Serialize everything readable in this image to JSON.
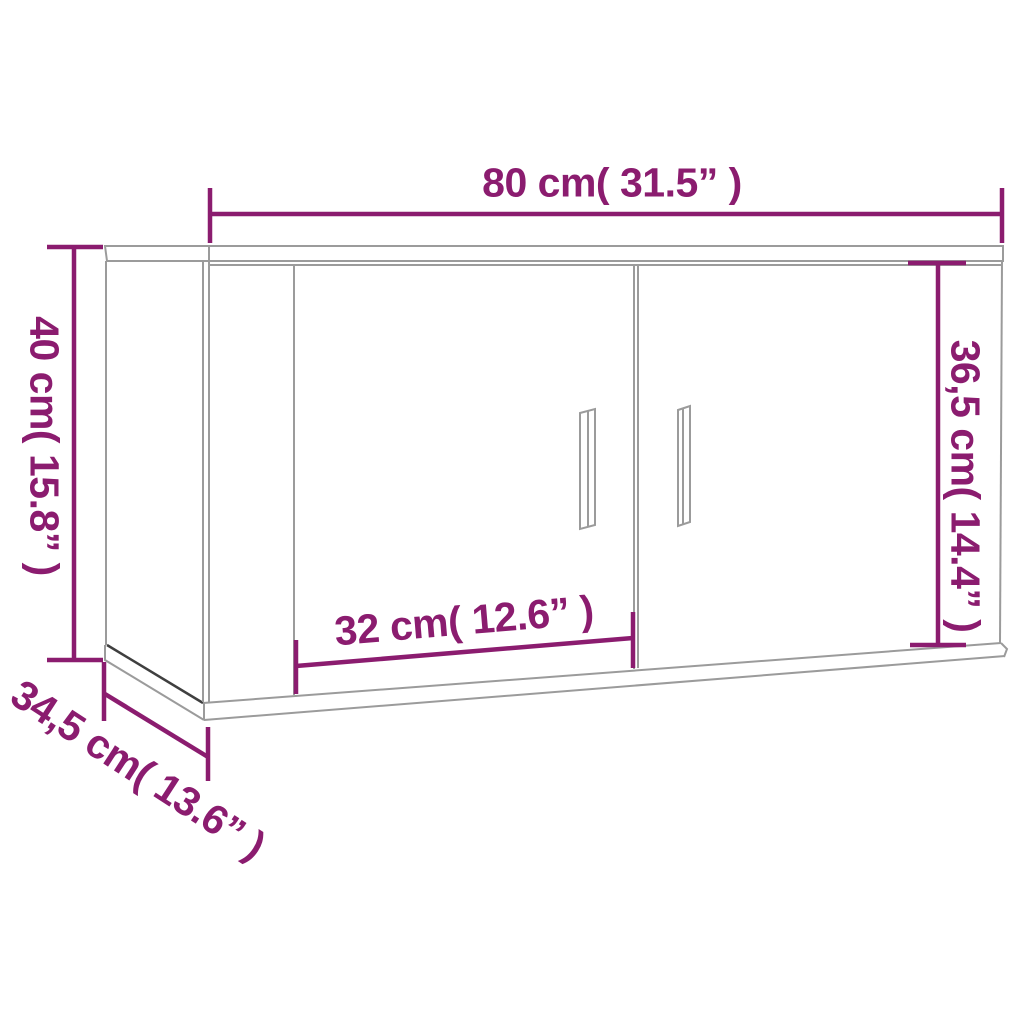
{
  "diagram": {
    "type": "product-dimension-diagram",
    "subject": "wall-mounted cabinet with two doors",
    "background": "#ffffff",
    "accent_color": "#8b1c6f",
    "line_color": "#9b9b9b",
    "labels": {
      "width": "80 cm( 31.5” )",
      "height": "40 cm( 15.8” )",
      "door_height": "36,5 cm( 14.4” )",
      "door_width": "32 cm( 12.6” )",
      "depth": "34,5 cm( 13.6” )"
    },
    "measurements": {
      "width_cm": 80,
      "width_in": 31.5,
      "height_cm": 40,
      "height_in": 15.8,
      "door_height_cm": 36.5,
      "door_height_in": 14.4,
      "door_width_cm": 32,
      "door_width_in": 12.6,
      "depth_cm": 34.5,
      "depth_in": 13.6
    }
  }
}
